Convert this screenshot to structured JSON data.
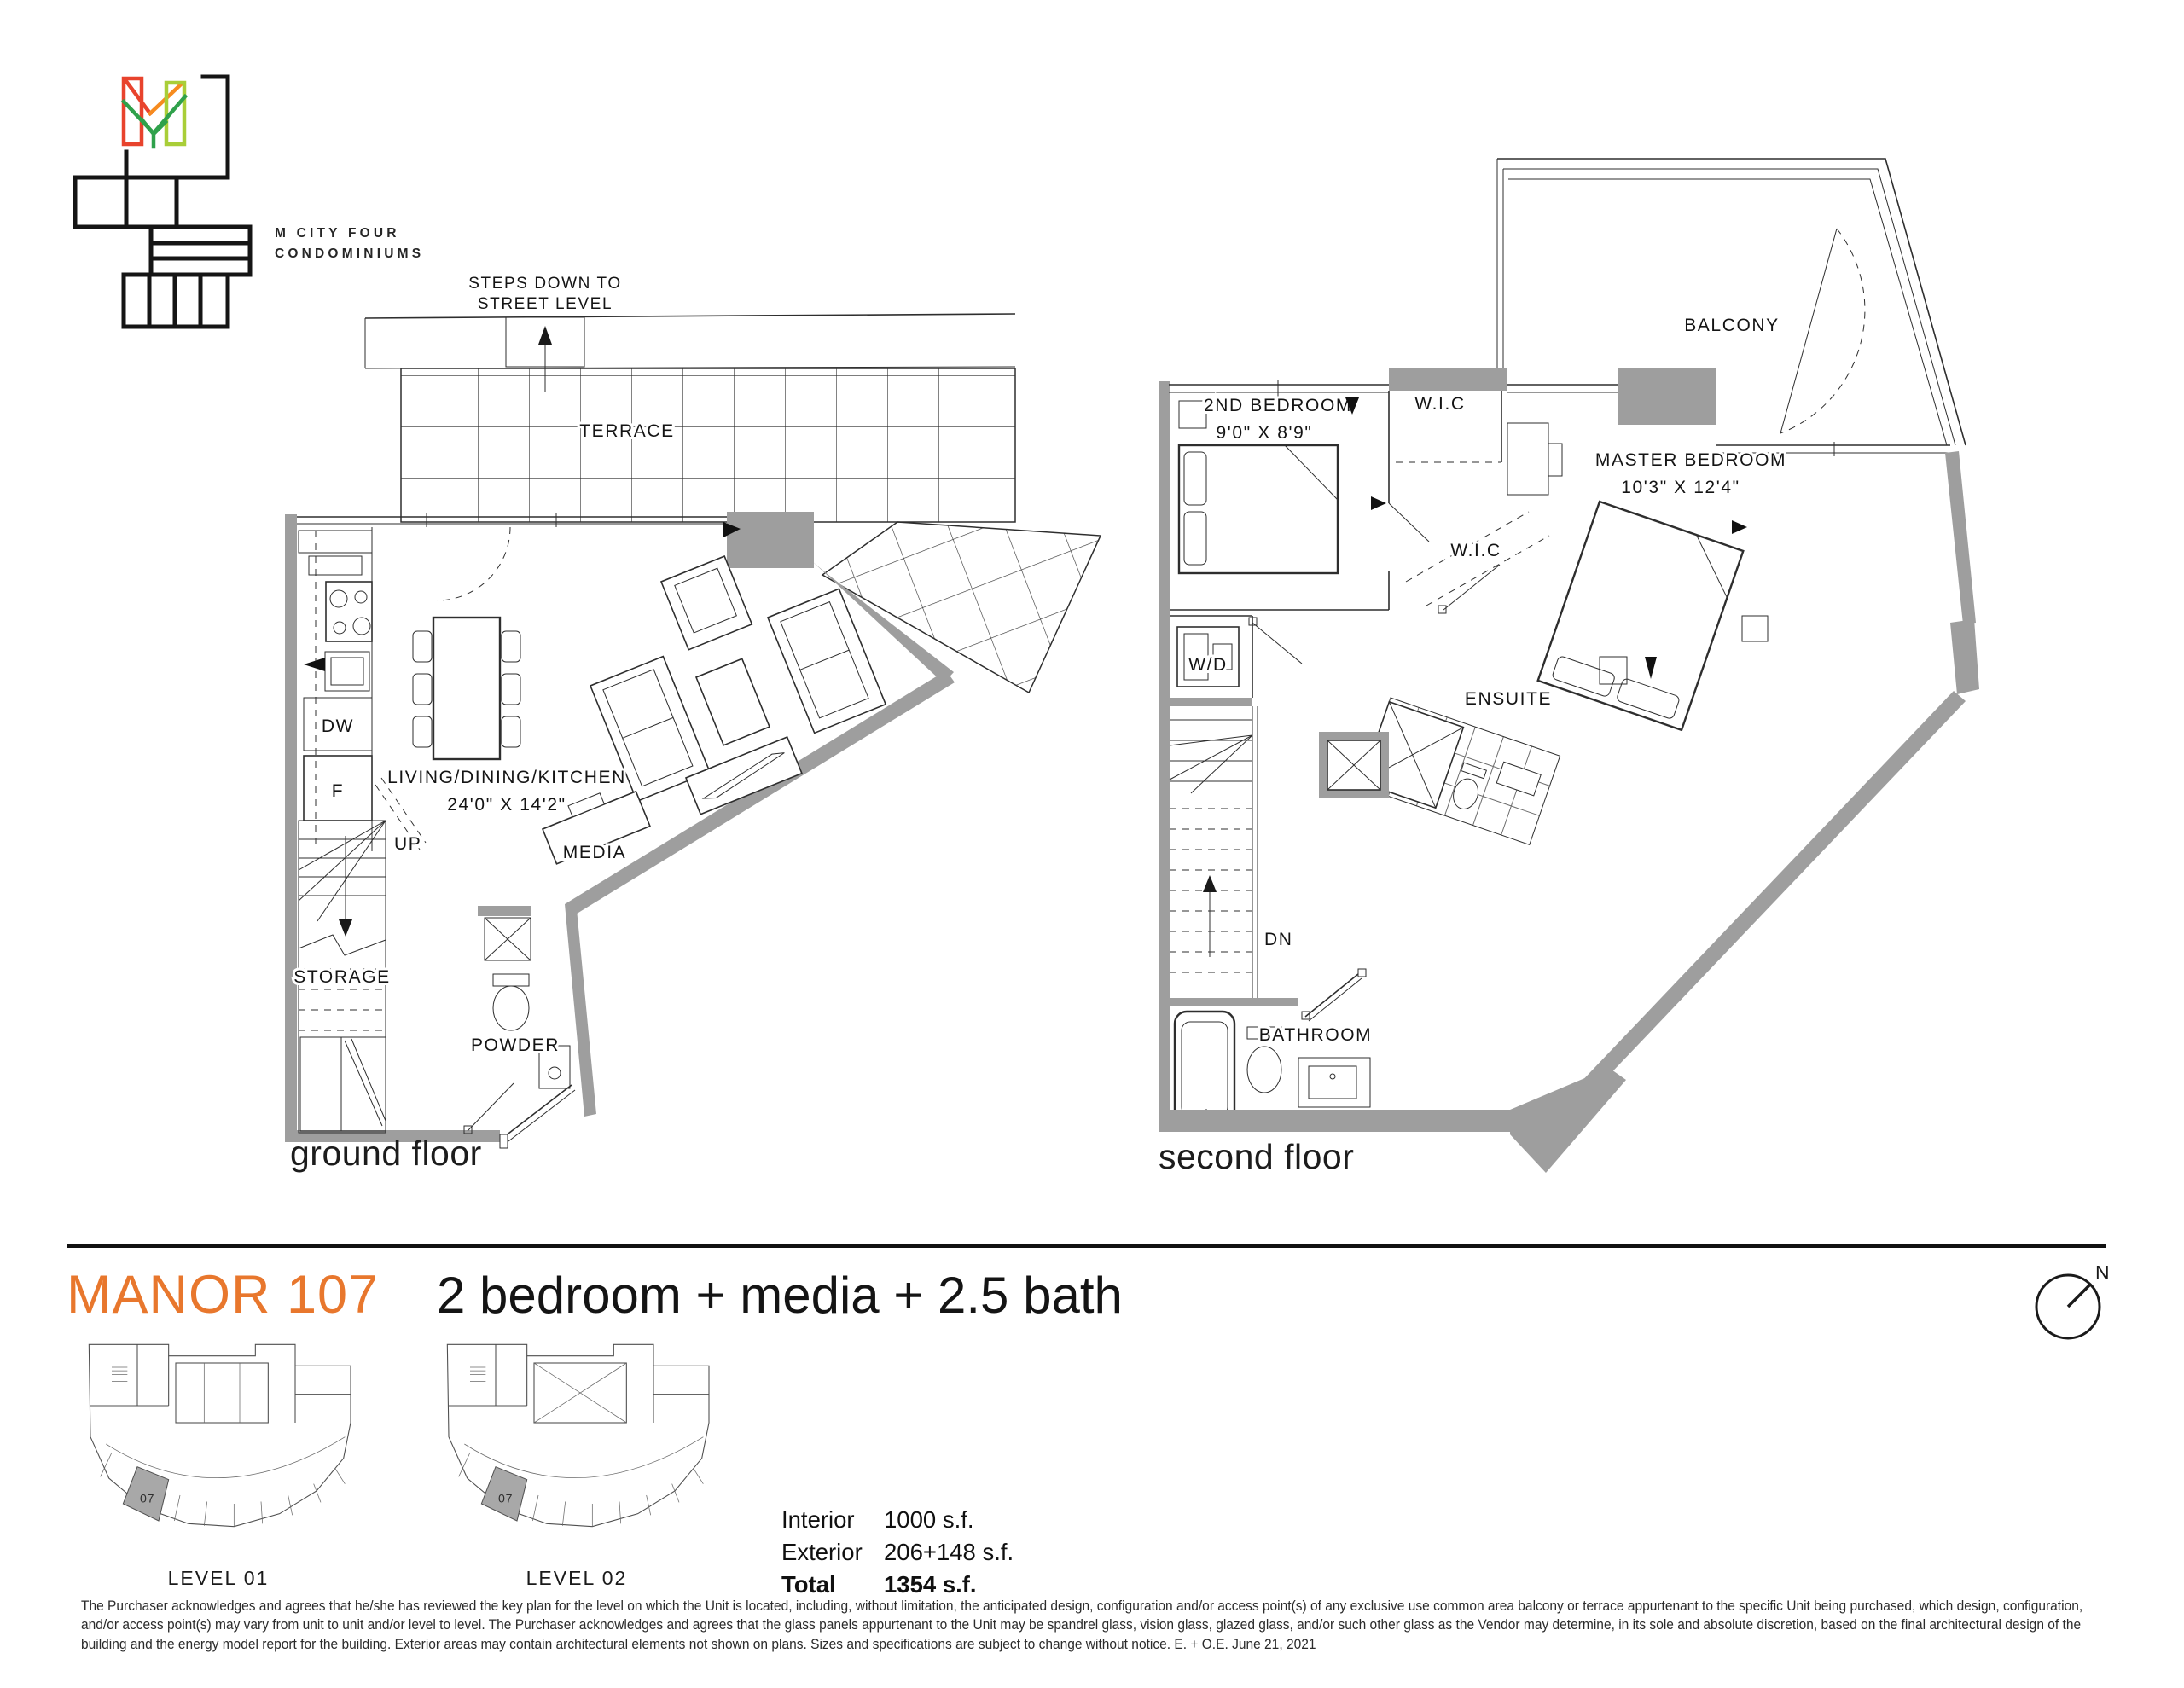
{
  "brand": {
    "line1": "M CITY FOUR",
    "line2": "CONDOMINIUMS"
  },
  "unit": {
    "name": "MANOR 107",
    "description": "2 bedroom + media + 2.5 bath"
  },
  "colors": {
    "accent": "#E8772D",
    "wall_gray": "#9E9E9E",
    "logo_red": "#E8432D",
    "logo_orange": "#F68B1F",
    "logo_light_green": "#A9CE38",
    "logo_dark_green": "#2FA14B",
    "keyplan_highlight": "#A8A8A8"
  },
  "ground_floor": {
    "caption": "ground floor",
    "steps_note_line1": "STEPS DOWN TO",
    "steps_note_line2": "STREET LEVEL",
    "labels": {
      "terrace": "TERRACE",
      "living": "LIVING/DINING/KITCHEN",
      "living_dims": "24'0\" X 14'2\"",
      "media": "MEDIA",
      "up": "UP",
      "storage": "STORAGE",
      "powder": "POWDER",
      "dishwasher": "DW",
      "fridge": "F"
    }
  },
  "second_floor": {
    "caption": "second floor",
    "labels": {
      "balcony": "BALCONY",
      "second_bedroom": "2ND BEDROOM",
      "second_bedroom_dims": "9'0\" X 8'9\"",
      "wic_upper": "W.I.C",
      "wic_lower": "W.I.C",
      "master_bedroom": "MASTER BEDROOM",
      "master_bedroom_dims": "10'3\" X 12'4\"",
      "washer_dryer": "W/D",
      "ensuite": "ENSUITE",
      "down": "DN",
      "bathroom": "BATHROOM"
    }
  },
  "key_plans": [
    {
      "label": "LEVEL 01",
      "unit_number": "07"
    },
    {
      "label": "LEVEL 02",
      "unit_number": "07"
    }
  ],
  "areas": {
    "rows": [
      {
        "label": "Interior",
        "value": "1000 s.f."
      },
      {
        "label": "Exterior",
        "value": "206+148 s.f."
      },
      {
        "label": "Total",
        "value": "1354 s.f."
      }
    ]
  },
  "compass": {
    "label": "N"
  },
  "disclaimer": "The Purchaser acknowledges and agrees that he/she has reviewed the key plan for the level on which the Unit is located, including, without limitation, the anticipated design, configuration and/or access point(s) of any exclusive use common area balcony or terrace appurtenant to the specific Unit being purchased, which design, configuration, and/or access point(s) may vary from unit to unit and/or level to level. The Purchaser acknowledges and agrees that the glass panels appurtenant to the Unit may be spandrel glass, vision glass, glazed glass, and/or such other glass as the Vendor may determine, in its sole and absolute discretion, based on the final architectural design of the building and the energy model report for the building. Exterior areas may contain architectural elements not shown on plans. Sizes and specifications are subject to change without notice. E. + O.E.  June 21, 2021"
}
